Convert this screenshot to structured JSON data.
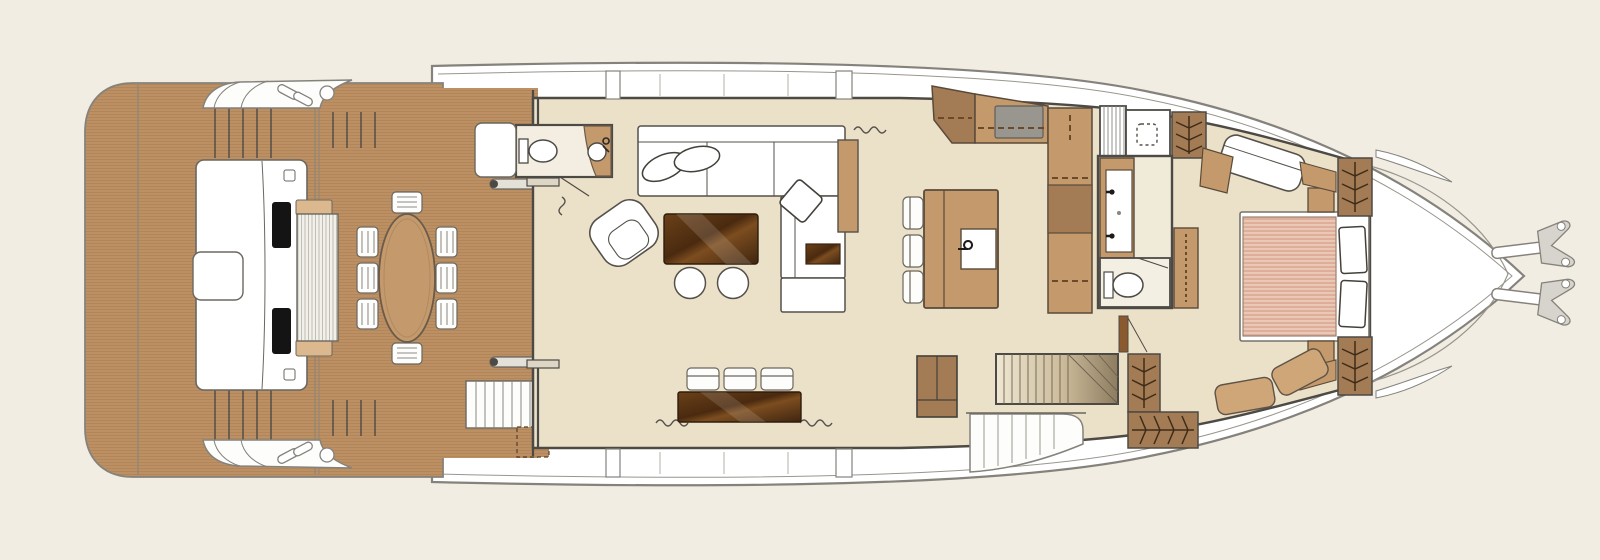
{
  "title": "Motor yacht main deck floor plan",
  "colors": {
    "background": "#f2ede3",
    "hull_fill": "#ffffff",
    "hull_stroke": "#85827c",
    "wall": "#4d4a45",
    "teak": "#c6996b",
    "teak_stripe": "#684521",
    "floor": "#ebe1c8",
    "room_light": "#f3eee1",
    "tan": "#c49a6d",
    "tan_light": "#dbb88d",
    "cabinet": "#a37c55",
    "dark_wood": "#4a2c12",
    "mattress": "#e3b39c",
    "appliance_gray": "#98968f",
    "black": "#141414",
    "door_brown": "#8a5a2e",
    "stair_light": "#efe7d2",
    "stair_dark": "#8d7c5f",
    "hanger": "#3f2c18",
    "metal": "#d7d4cd"
  },
  "inventory": {
    "aft_platform": [
      "teak swim platform",
      "transom seat with slatted bench",
      "two speakers",
      "stern steps",
      "cleats",
      "railings"
    ],
    "aft_deck": [
      "oval dining table",
      "eight dining chairs",
      "boarding gates",
      "deck hatch",
      "stairway with quarter turn"
    ],
    "day_head": [
      "toilet",
      "corner basin with faucet",
      "privacy curtain"
    ],
    "salon": [
      "l-shaped sofa",
      "two oval pillows",
      "diamond pillow",
      "swivel armchair",
      "coffee table",
      "two ottomans",
      "side table",
      "sideboard",
      "three stools",
      "tall cabinet",
      "curtains"
    ],
    "galley": [
      "island with sink",
      "three bar stools",
      "l-shaped counter",
      "cooktop",
      "overhead lockers (dashed)",
      "tall units"
    ],
    "midship": [
      "stairs up",
      "shower",
      "double vanity",
      "toilet room",
      "wardrobes with hangers",
      "stairs down to lower deck",
      "side-deck steps"
    ],
    "master_cabin": [
      "double bed with striped mattress",
      "two pillows",
      "two nightstands",
      "wardrobes with hangers",
      "chaise seat",
      "desk",
      "curved settee",
      "entry door"
    ],
    "bow": [
      "pointed foredeck",
      "spray strakes",
      "twin anchors"
    ]
  },
  "counts": {
    "dining_chairs": 8,
    "salon_stools": 3,
    "galley_stools": 3,
    "ottomans": 2,
    "anchors": 2,
    "wardrobe_units": 6
  }
}
